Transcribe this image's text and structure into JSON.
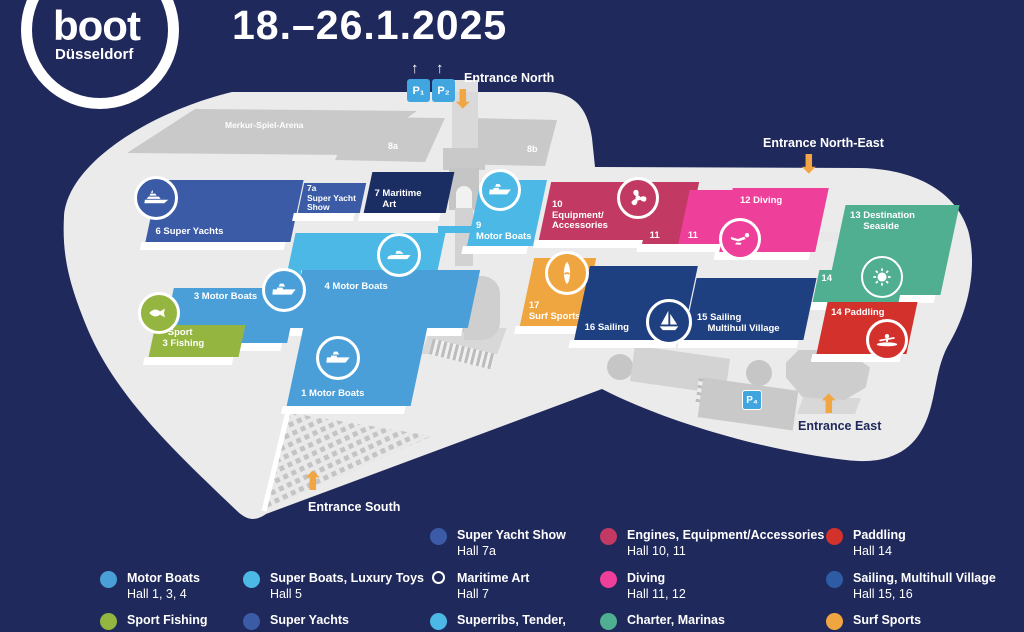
{
  "brand": {
    "logo_text": "boot",
    "logo_city": "Düsseldorf",
    "dates": "18.–26.1.2025"
  },
  "colors": {
    "navy_bg": "#20295c",
    "map_gray": "#ebebeb",
    "building_gray": "#c9c9c9",
    "blue": "#4b9fd9",
    "cyan": "#4cb8e5",
    "royal": "#3b5ba6",
    "deep_navy": "#1a2e63",
    "navy2": "#1f4080",
    "green": "#95b541",
    "crimson": "#c23a64",
    "pink": "#ee3f9a",
    "teal": "#50ae91",
    "red": "#d2312c",
    "orange": "#f0a640",
    "parking_blue": "#41a6e0",
    "arrow_orange": "#f2a643",
    "legend_sailing_blue": "#2e5ca4"
  },
  "icons": {
    "arrow_up": "⬆",
    "arrow_down": "⬇",
    "p_arrow": "↑"
  },
  "map": {
    "arena_label": "Merkur-Spiel-Arena",
    "gray_halls": [
      {
        "label": "8a"
      },
      {
        "label": "8b"
      }
    ],
    "parking": {
      "p1": "P₁",
      "p2": "P₂",
      "p4": "P₄"
    },
    "entrances": {
      "north": "Entrance North",
      "north_east": "Entrance North-East",
      "east": "Entrance East",
      "south": "Entrance South"
    },
    "halls": [
      {
        "id": "6",
        "label": "6 Super Yachts",
        "color": "royal",
        "icon": "super-yacht"
      },
      {
        "id": "7a",
        "label": "7a\nSuper Yacht\nShow",
        "color": "royal"
      },
      {
        "id": "7",
        "label": "7 Maritime\n   Art",
        "color": "deep_navy"
      },
      {
        "id": "5",
        "label": "5 Super Boats",
        "color": "cyan",
        "icon": "speedboat"
      },
      {
        "id": "4",
        "label": "4 Motor Boats",
        "color": "blue",
        "icon": "motorboat"
      },
      {
        "id": "3",
        "label": "3 Motor Boats",
        "color": "blue",
        "icon": "fish"
      },
      {
        "id": "3f",
        "label": "  Sport\n3 Fishing",
        "color": "green"
      },
      {
        "id": "1",
        "label": "1 Motor Boats",
        "color": "blue",
        "icon": "motorboat"
      },
      {
        "id": "9",
        "label": "9\nMotor Boats",
        "color": "cyan",
        "icon": "motorboat"
      },
      {
        "id": "10",
        "label": "10\nEquipment/\nAccessories",
        "color": "crimson",
        "icon": "propeller"
      },
      {
        "id": "11a",
        "label": "11",
        "color": "crimson"
      },
      {
        "id": "11b",
        "label": "11",
        "color": "pink"
      },
      {
        "id": "12",
        "label": "12 Diving",
        "color": "pink",
        "icon": "diver"
      },
      {
        "id": "13",
        "label": "13 Destination\n     Seaside",
        "color": "teal",
        "icon": "sun"
      },
      {
        "id": "14t",
        "label": "14",
        "color": "teal"
      },
      {
        "id": "14",
        "label": "14 Paddling",
        "color": "red",
        "icon": "kayak"
      },
      {
        "id": "17",
        "label": "17\nSurf Sports",
        "color": "orange",
        "icon": "surfboard"
      },
      {
        "id": "16",
        "label": "16 Sailing",
        "color": "navy2"
      },
      {
        "id": "15",
        "label": "15 Sailing\n    Multihull Village",
        "color": "navy2",
        "icon": "sailboat"
      }
    ]
  },
  "legend": {
    "items": [
      {
        "title": "Super Yacht Show",
        "subtitle": "Hall 7a",
        "color": "royal"
      },
      {
        "title": "Engines, Equipment/Accessories",
        "subtitle": "Hall 10, 11",
        "color": "crimson"
      },
      {
        "title": "Paddling",
        "subtitle": "Hall 14",
        "color": "red"
      },
      {
        "title": "Motor Boats",
        "subtitle": "Hall 1, 3, 4",
        "color": "blue"
      },
      {
        "title": "Super Boats, Luxury Toys",
        "subtitle": "Hall 5",
        "color": "cyan"
      },
      {
        "title": "Maritime Art",
        "subtitle": "Hall 7",
        "color": "outline"
      },
      {
        "title": "Diving",
        "subtitle": "Hall 11, 12",
        "color": "pink"
      },
      {
        "title": "Sailing, Multihull Village",
        "subtitle": "Hall 15, 16",
        "color": "legend_sailing_blue"
      },
      {
        "title": "Sport Fishing",
        "subtitle": "",
        "color": "green"
      },
      {
        "title": "Super Yachts",
        "subtitle": "",
        "color": "royal"
      },
      {
        "title": "Superribs, Tender,",
        "subtitle": "",
        "color": "cyan"
      },
      {
        "title": "Charter, Marinas",
        "subtitle": "",
        "color": "teal"
      },
      {
        "title": "Surf Sports",
        "subtitle": "",
        "color": "orange"
      }
    ]
  }
}
